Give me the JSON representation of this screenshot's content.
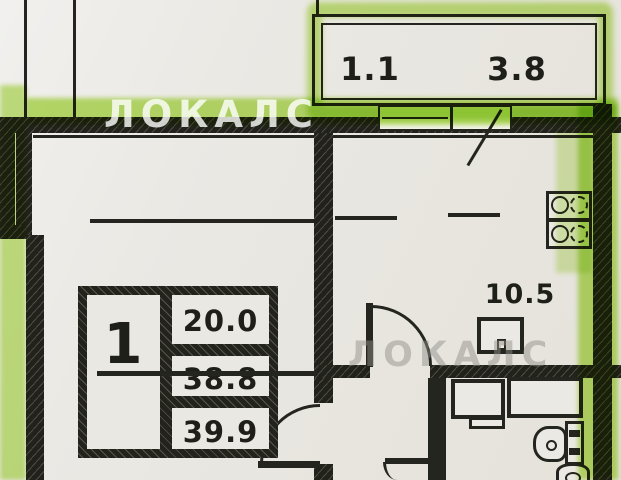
{
  "plan": {
    "type": "apartment-floor-plan",
    "watermarks": [
      {
        "text": "ЛОКАЛС"
      },
      {
        "text": "ЛОКАЛС"
      }
    ],
    "balcony": {
      "area_small": "1.1",
      "area_large": "3.8"
    },
    "kitchen": {
      "area": "10.5"
    },
    "stamp": {
      "rooms": "1",
      "living_area": "20.0",
      "apartment_area": "38.8",
      "total_area": "39.9"
    },
    "colors": {
      "paper": "#e9e7e1",
      "ink": "#25251f",
      "highlighter": "#b1de54",
      "watermark": "#ffffff"
    },
    "fixtures": {
      "stove": "stove-4-burners",
      "kitchen_sink": "kitchen-sink",
      "toilet": "toilet",
      "washbasin": "washbasin",
      "washing_machine": "washing-machine",
      "bathtub": "bathtub"
    }
  }
}
